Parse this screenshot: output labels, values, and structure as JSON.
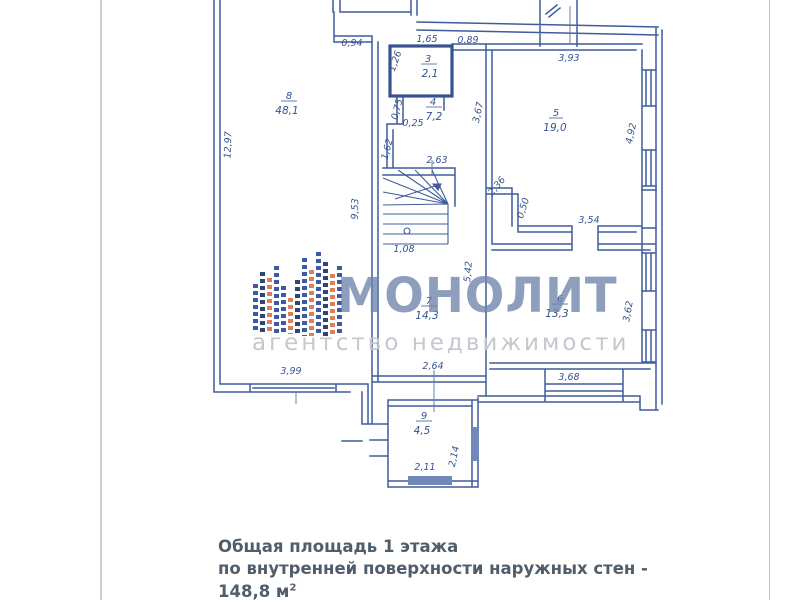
{
  "plan": {
    "rooms": [
      {
        "number": "3",
        "area": "2,1"
      },
      {
        "number": "4",
        "area": "7,2"
      },
      {
        "number": "5",
        "area": "19,0"
      },
      {
        "number": "6",
        "area": "13,3"
      },
      {
        "number": "7",
        "area": "14,3"
      },
      {
        "number": "8",
        "area": "48,1"
      },
      {
        "number": "9",
        "area": "4,5"
      }
    ],
    "dimensions": {
      "l_094": "0,94",
      "l_165": "1,65",
      "l_089": "0,89",
      "l_126": "1,26",
      "l_075": "0,75",
      "l_025": "0,25",
      "l_162": "1,62",
      "l_367": "3,67",
      "l_263": "2,63",
      "l_393": "3,93",
      "l_492": "4,92",
      "l_1297": "12,97",
      "l_953": "9,53",
      "l_236": "2,36",
      "l_050": "0,50",
      "l_108": "1,08",
      "l_354": "3,54",
      "l_542": "5,42",
      "l_362": "3,62",
      "l_368": "3,68",
      "l_264": "2,64",
      "l_399": "3,99",
      "l_214": "2,14",
      "l_211": "2,11"
    }
  },
  "watermark": {
    "title": "МОНОЛИТ",
    "subtitle": "агентство недвижимости"
  },
  "caption": {
    "line1": "Общая площадь 1 этажа",
    "line2": "по внутренней поверхности наружных стен - 148,8 м",
    "sup": "2"
  },
  "colors": {
    "wall": "#3f5c9c",
    "dim_text": "#35548e",
    "watermark_title": "#6e84aa",
    "watermark_subtitle": "#c4c8ce",
    "caption_text": "#505d6b",
    "logo_blue": "#3d5ba4",
    "logo_orange": "#dd8057"
  }
}
